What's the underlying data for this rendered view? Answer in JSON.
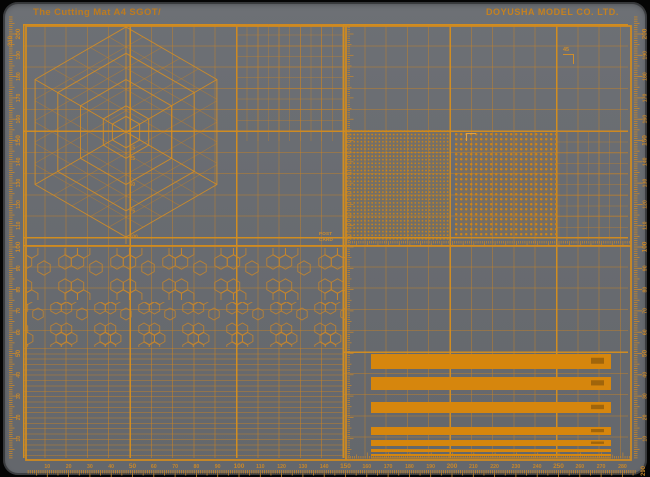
{
  "titles": {
    "product": "The Cutting Mat A4 SGOT/",
    "brand": "DOYUSHA MODEL CO. LTD."
  },
  "iso_guide": {
    "labels": [
      "15",
      "25",
      "50",
      "75",
      "100"
    ]
  },
  "labels": {
    "post_card": {
      "line1": "POST",
      "line2": "CARD"
    },
    "square_45": "45",
    "left_corner": "210",
    "bottom_corner": "290"
  },
  "rulers": {
    "bottom": {
      "unit": "mm",
      "values": [
        10,
        20,
        30,
        40,
        50,
        60,
        70,
        80,
        90,
        100,
        110,
        120,
        130,
        140,
        150,
        160,
        170,
        180,
        190,
        200,
        210,
        220,
        230,
        240,
        250,
        260,
        270,
        280
      ],
      "bold": [
        50,
        100,
        150,
        200,
        250
      ]
    },
    "left": {
      "unit": "mm",
      "values": [
        10,
        20,
        30,
        40,
        50,
        60,
        70,
        80,
        90,
        100,
        110,
        120,
        130,
        140,
        150,
        160,
        170,
        180,
        190,
        200
      ],
      "bold": [
        50,
        100,
        150,
        200
      ]
    },
    "right": {
      "unit": "mm",
      "values": [
        10,
        20,
        30,
        40,
        50,
        60,
        70,
        80,
        90,
        100,
        110,
        120,
        130,
        140,
        150,
        160,
        170,
        180,
        190,
        200
      ],
      "bold": [
        50,
        100,
        150,
        200
      ]
    }
  },
  "line_samples": {
    "thicknesses_px": [
      15,
      13,
      11,
      8,
      6,
      3,
      2,
      1
    ]
  },
  "colors": {
    "mat": "#696c71",
    "line": "#c8872a",
    "line_strong": "#d28e1e",
    "bar": "#d6860d",
    "title": "#bc7b1f"
  }
}
